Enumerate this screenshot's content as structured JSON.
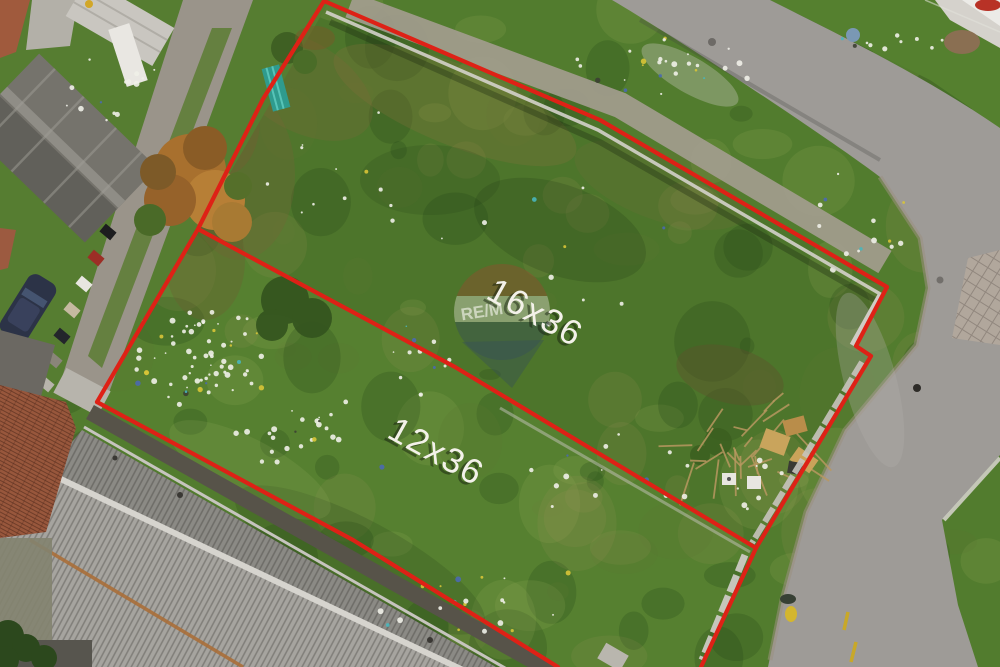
{
  "labels": {
    "lot_upper": "16x36",
    "lot_lower": "12x36"
  },
  "watermark": {
    "text": "RE/M"
  },
  "colors": {
    "boundary": "#de2116",
    "label_text": "#f3f1e9",
    "grass": "#527c2e",
    "road": "#9e9b97",
    "roof_metal": "#a6a49f",
    "roof_tile": "#98573c"
  }
}
